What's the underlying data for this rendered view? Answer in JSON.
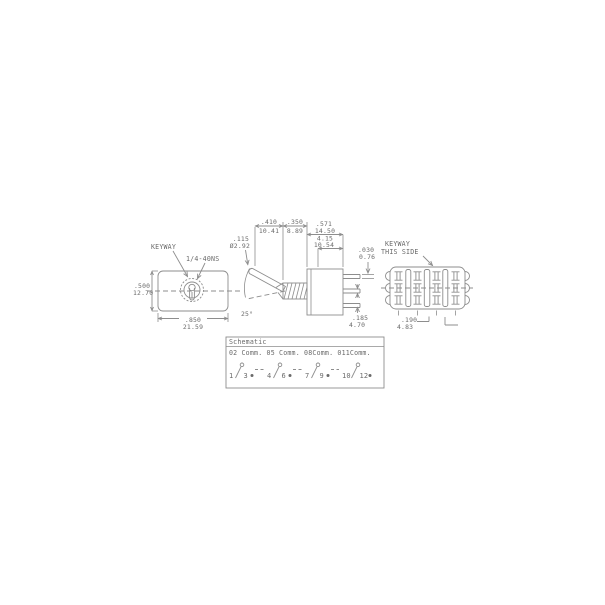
{
  "drawing": {
    "colors": {
      "line": "#8d8d8d",
      "text": "#6a6a6a",
      "background": "#ffffff"
    },
    "front_view": {
      "keyway_label": "KEYWAY",
      "thread_label": "1/4-40NS",
      "height_in": ".500",
      "height_mm": "12.70",
      "width_in": ".850",
      "width_mm": "21.59"
    },
    "side_view": {
      "lever_dia_in": ".115",
      "lever_dia_mm": "Ø2.92",
      "lever_len_in": ".410",
      "lever_len_mm": "10.41",
      "bushing_len_in": ".350",
      "bushing_len_mm": "8.89",
      "body_len_in": ".571",
      "body_len_mm": "14.50",
      "inner_len_in": "4.15",
      "inner_len_mm": "10.54",
      "terminal_thickness_in": ".030",
      "terminal_thickness_mm": "0.76",
      "terminal_spacing_in": ".185",
      "terminal_spacing_mm": "4.70",
      "throw_angle": "25°"
    },
    "rear_view": {
      "keyway_note_line1": "KEYWAY",
      "keyway_note_line2": "THIS SIDE",
      "pitch_in": ".190",
      "pitch_mm": "4.83"
    },
    "schematic": {
      "title": "Schematic",
      "commons_note": "02 Comm. 05 Comm. 08Comm. 011Comm.",
      "poles": [
        {
          "left": "1",
          "right": "3"
        },
        {
          "left": "4",
          "right": "6"
        },
        {
          "left": "7",
          "right": "9"
        },
        {
          "left": "10",
          "right": "12"
        }
      ]
    }
  }
}
